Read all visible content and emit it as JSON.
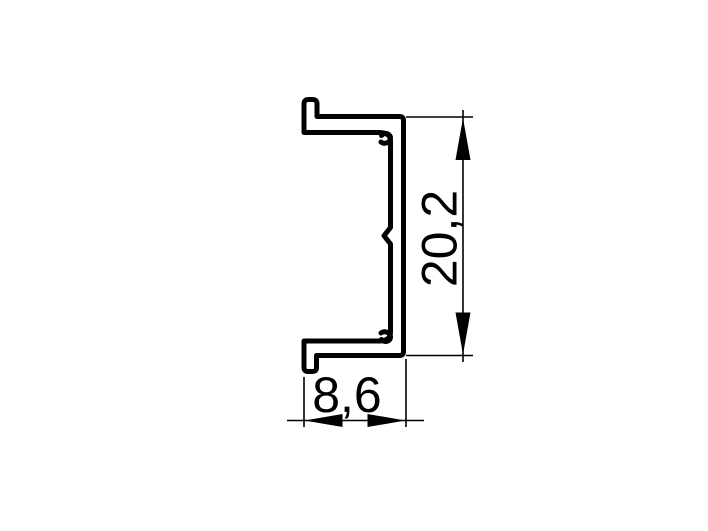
{
  "drawing": {
    "title": "aluminium profile cross-section",
    "view": "2d outline with dimensions",
    "dimensions": {
      "height": {
        "value": "20,2",
        "orientation": "vertical"
      },
      "width": {
        "value": "8,6",
        "orientation": "horizontal"
      }
    },
    "colors": {
      "line": "#000000",
      "background": "#ffffff",
      "text": "#000000"
    }
  }
}
